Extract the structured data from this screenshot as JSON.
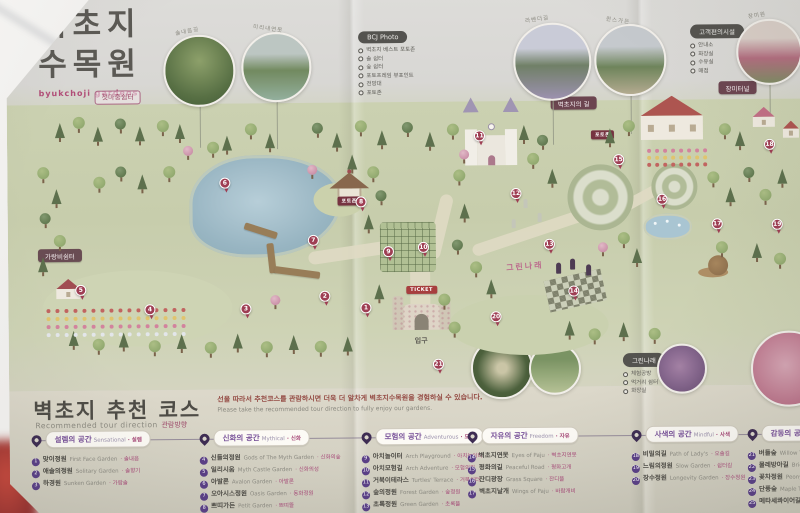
{
  "title": {
    "korean_line1": "벽초지",
    "korean_line2": "수목원",
    "english": "byukchoji gardens"
  },
  "header": {
    "welcome_badge": "첫마중쉼터",
    "rose_badge": "장미터널",
    "path_badge": "벽초지의 길",
    "photo_legend": {
      "title": "BCJ Photo",
      "items": [
        "벽초지 베스트 포토존",
        "솔 쉼터",
        "숲 쉼터",
        "포토프레임 뷰포인트",
        "전망대",
        "포토존"
      ]
    },
    "facility_legend": {
      "title": "고객편의시설",
      "items": [
        "안내소",
        "화장실",
        "수유실",
        "매점"
      ]
    },
    "photos": [
      {
        "label": "솔내음길"
      },
      {
        "label": "미리내연못"
      },
      {
        "label": "라벤더길"
      },
      {
        "label": "퀸스가든"
      },
      {
        "label": "장미원"
      }
    ]
  },
  "map": {
    "labels": {
      "entrance": "입구",
      "ticket": "TICKET",
      "rest_badge": "가랑비쉼터",
      "photo_sign": "포토존",
      "green_narae": "그린나래"
    },
    "green_narae_legend": {
      "title": "그린나래",
      "items": [
        "체험공방",
        "먹거리 쉼터",
        "화장실"
      ]
    },
    "pins": [
      {
        "n": "1",
        "x": 352,
        "y": 306
      },
      {
        "n": "2",
        "x": 311,
        "y": 294
      },
      {
        "n": "3",
        "x": 232,
        "y": 306
      },
      {
        "n": "4",
        "x": 136,
        "y": 306
      },
      {
        "n": "5",
        "x": 67,
        "y": 286
      },
      {
        "n": "6",
        "x": 212,
        "y": 180
      },
      {
        "n": "7",
        "x": 300,
        "y": 238
      },
      {
        "n": "8",
        "x": 348,
        "y": 200
      },
      {
        "n": "9",
        "x": 375,
        "y": 250
      },
      {
        "n": "10",
        "x": 410,
        "y": 246
      },
      {
        "n": "11",
        "x": 467,
        "y": 135
      },
      {
        "n": "12",
        "x": 503,
        "y": 193
      },
      {
        "n": "13",
        "x": 536,
        "y": 244
      },
      {
        "n": "14",
        "x": 560,
        "y": 291
      },
      {
        "n": "15",
        "x": 606,
        "y": 160
      },
      {
        "n": "16",
        "x": 649,
        "y": 200
      },
      {
        "n": "17",
        "x": 704,
        "y": 225
      },
      {
        "n": "18",
        "x": 757,
        "y": 146
      },
      {
        "n": "19",
        "x": 764,
        "y": 226
      },
      {
        "n": "20",
        "x": 482,
        "y": 316
      },
      {
        "n": "21",
        "x": 424,
        "y": 363
      }
    ]
  },
  "course": {
    "title": "벽초지 추천 코스",
    "subtitle": "Recommended tour direction",
    "subtitle_tag": "관람방향",
    "note_korean": "선을 따라서 추천코스를 관람하시면 더욱 더 알차게 벽초지수목원을 경험하실 수 있습니다.",
    "note_english": "Please take the recommended tour direction to fully enjoy our gardens.",
    "sections": [
      {
        "name": "설렘의 공간",
        "english": "Sensational",
        "tag": "설렘",
        "items": [
          {
            "num": "1",
            "kr": "맞이정원",
            "en": "First Face Garden",
            "tag": "솔내음"
          },
          {
            "num": "2",
            "kr": "애솔의정원",
            "en": "Solitary Garden",
            "tag": "솔향기"
          },
          {
            "num": "3",
            "kr": "하경원",
            "en": "Sunken Garden",
            "tag": "가람솔"
          }
        ]
      },
      {
        "name": "신화의 공간",
        "english": "Mythical",
        "tag": "신화",
        "items": [
          {
            "num": "4",
            "kr": "신들의정원",
            "en": "Gods of The Myth Garden",
            "tag": "신화의숲"
          },
          {
            "num": "5",
            "kr": "일리시움",
            "en": "Myth Castle Garden",
            "tag": "신화의성"
          },
          {
            "num": "6",
            "kr": "아발론",
            "en": "Avalon Garden",
            "tag": "아발론"
          },
          {
            "num": "7",
            "kr": "오아시스정원",
            "en": "Oasis Garden",
            "tag": "동화정원"
          },
          {
            "num": "8",
            "kr": "쁘띠가든",
            "en": "Petit Garden",
            "tag": "쁘띠뜰"
          }
        ]
      },
      {
        "name": "모험의 공간",
        "english": "Adventurous",
        "tag": "모험",
        "items": [
          {
            "num": "9",
            "kr": "아치놀이터",
            "en": "Arch Playground",
            "tag": "아치놀이터"
          },
          {
            "num": "10",
            "kr": "아치모험길",
            "en": "Arch Adventure",
            "tag": "모험의길"
          },
          {
            "num": "11",
            "kr": "거북이테라스",
            "en": "Turtles' Terrace",
            "tag": "거북쉼터"
          },
          {
            "num": "12",
            "kr": "숲의정원",
            "en": "Forest Garden",
            "tag": "숲정원"
          },
          {
            "num": "13",
            "kr": "초록정원",
            "en": "Green Garden",
            "tag": "초록뜰"
          }
        ]
      },
      {
        "name": "자유의 공간",
        "english": "Freedom",
        "tag": "자유",
        "items": [
          {
            "num": "14",
            "kr": "벽초지연못",
            "en": "Eyes of Paju",
            "tag": "벽초지연못"
          },
          {
            "num": "15",
            "kr": "평화의길",
            "en": "Peaceful Road",
            "tag": "평화고개"
          },
          {
            "num": "16",
            "kr": "잔디광장",
            "en": "Grass Square",
            "tag": "잔디뜰"
          },
          {
            "num": "17",
            "kr": "벽초지날개",
            "en": "Wings of Paju",
            "tag": "바람개비"
          }
        ]
      },
      {
        "name": "사색의 공간",
        "english": "Mindful",
        "tag": "사색",
        "items": [
          {
            "num": "18",
            "kr": "비밀의길",
            "en": "Path of Lady's",
            "tag": "오솔길"
          },
          {
            "num": "19",
            "kr": "느림의정원",
            "en": "Slow Garden",
            "tag": "쉼터길"
          },
          {
            "num": "20",
            "kr": "장수정원",
            "en": "Longevity Garden",
            "tag": "장수정원"
          }
        ]
      },
      {
        "name": "감동의 공간",
        "english": "Touching",
        "tag": "감동",
        "items": [
          {
            "num": "21",
            "kr": "버들숲",
            "en": "Willow Tree Path",
            "tag": "버들길"
          },
          {
            "num": "22",
            "kr": "물레방아길",
            "en": "Bridge of Turning Mill",
            "tag": "물레길"
          },
          {
            "num": "23",
            "kr": "꽃차정원",
            "en": "Peony Garden",
            "tag": "꽃마당"
          },
          {
            "num": "24",
            "kr": "단풍숲",
            "en": "Maple Tree Path",
            "tag": "단풍길"
          },
          {
            "num": "25",
            "kr": "메타세콰이어길",
            "en": "Metasequoia Road",
            "tag": "메타길"
          }
        ]
      }
    ]
  },
  "colors": {
    "accent_pink": "#b94a78",
    "pin_red": "#a63a52",
    "purple": "#5b3d8e",
    "badge_dark": "#6f4350"
  }
}
